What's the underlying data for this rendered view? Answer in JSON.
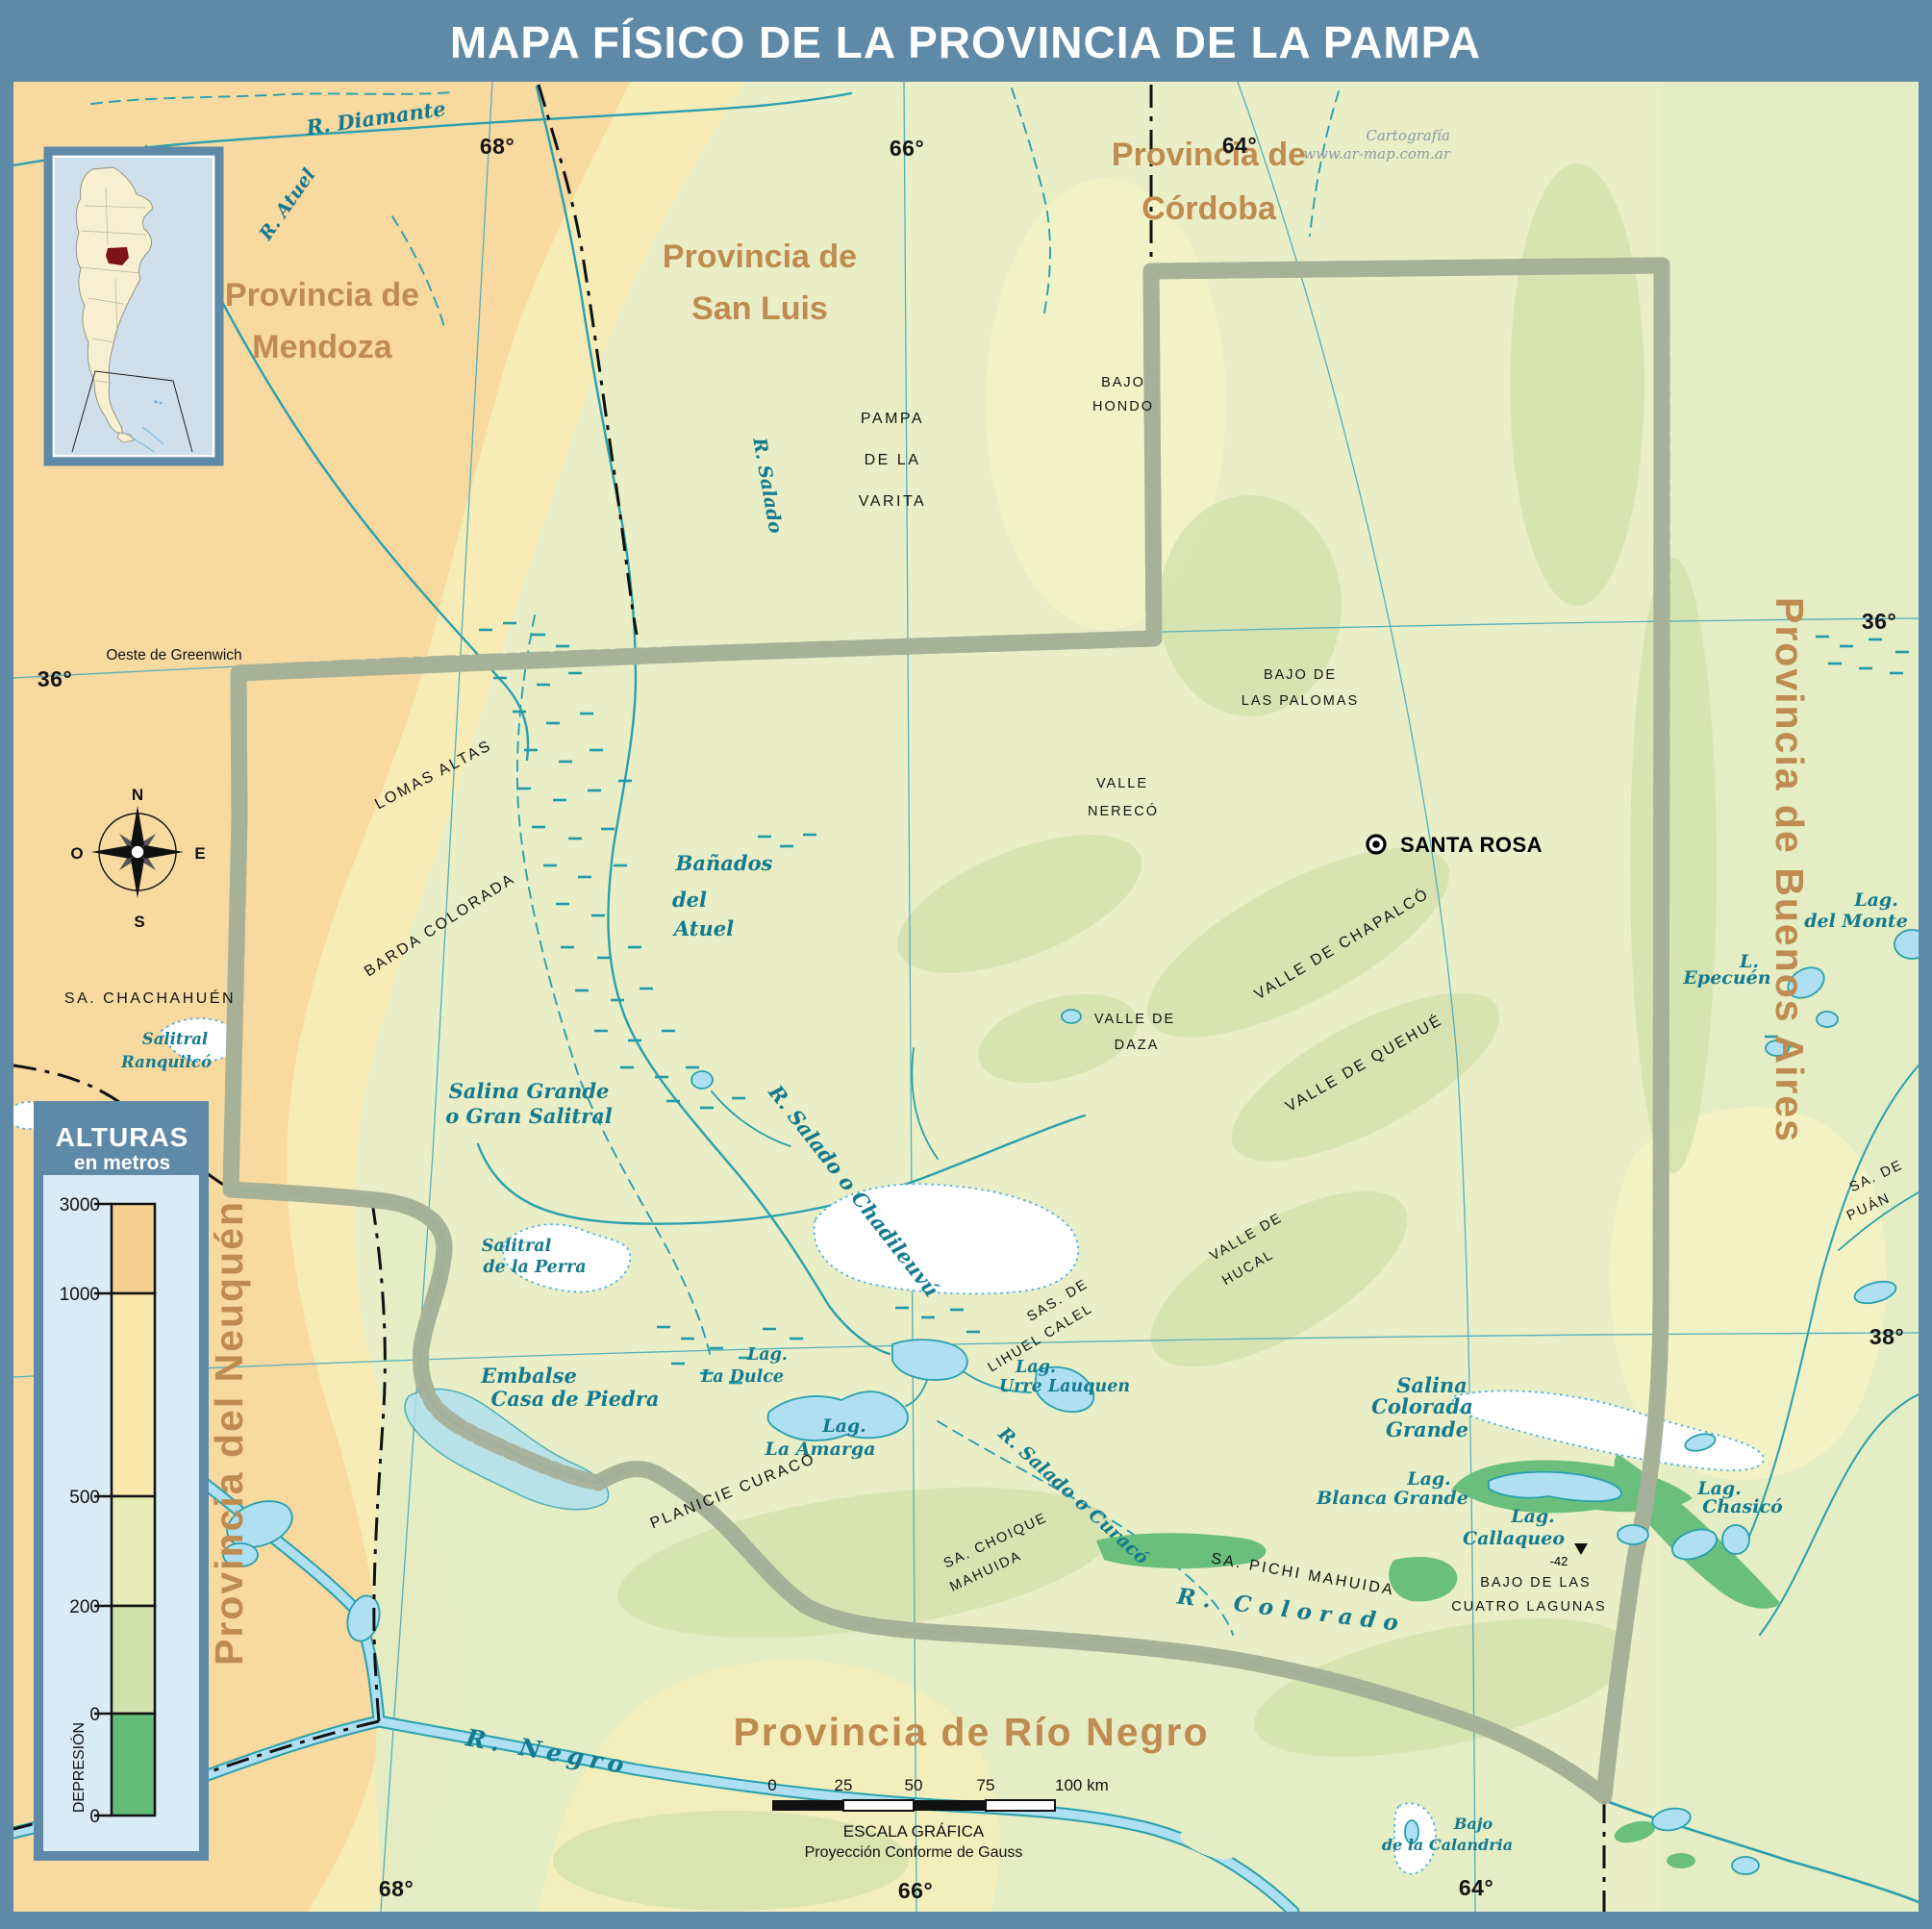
{
  "title": "MAPA FÍSICO DE LA PROVINCIA DE LA PAMPA",
  "credit": {
    "line1": "Cartografía",
    "line2": "www.ar-map.com.ar"
  },
  "colors": {
    "frame": "#5e89a7",
    "map_base": "#e9eec6",
    "west_orange": "#f8d9a0",
    "pale_yellow": "#f8ecb6",
    "valley_green": "#d3e2ad",
    "depression_green": "#69bf7b",
    "water_line": "#2aa0ae",
    "water_fill": "#aedff2",
    "water_label": "#157a8e",
    "province_label": "#bf8b51",
    "border_shadow": "#a6b199",
    "border_line": "#111111"
  },
  "graticule": {
    "greenwich": "Oeste de Greenwich",
    "top": [
      "68°",
      "66°",
      "64°"
    ],
    "bottom": [
      "68°",
      "66°",
      "64°"
    ],
    "left": [
      "36°"
    ],
    "right": [
      "36°",
      "38°"
    ]
  },
  "provinces": {
    "mendoza": [
      "Provincia de",
      "Mendoza"
    ],
    "sanluis": [
      "Provincia de",
      "San Luis"
    ],
    "cordoba": [
      "Provincia de",
      "Córdoba"
    ],
    "buenosaires": "Provincia de Buenos Aires",
    "neuquen": "Provincia del Neuquén",
    "rionegro": "Provincia de Río Negro"
  },
  "city": {
    "name": "SANTA ROSA"
  },
  "terrain": {
    "pampa1": "PAMPA",
    "pampa2": "DE LA",
    "pampa3": "VARITA",
    "bajohondo1": "BAJO",
    "bajohondo2": "HONDO",
    "palomas1": "BAJO DE",
    "palomas2": "LAS PALOMAS",
    "nereco1": "VALLE",
    "nereco2": "NERECÓ",
    "daza1": "VALLE DE",
    "daza2": "DAZA",
    "chapalco": "VALLE DE CHAPALCÓ",
    "quehue": "VALLE DE QUEHUÉ",
    "hucal1": "VALLE DE",
    "hucal2": "HUCAL",
    "lihuel1": "SAS. DE",
    "lihuel2": "LIHUEL CALEL",
    "choique1": "SA. CHOIQUE",
    "choique2": "MAHUIDA",
    "pichi": "SA. PICHI MAHUIDA",
    "cuatro1": "BAJO DE LAS",
    "cuatro2": "CUATRO LAGUNAS",
    "lomas": "LOMAS ALTAS",
    "barda": "BARDA COLORADA",
    "chachahuen": "SA. CHACHAHUÉN",
    "planicie": "PLANICIE CURACÓ",
    "puan1": "SA. DE",
    "puan2": "PUÁN",
    "depression_value": "-42"
  },
  "water": {
    "diamante": "R. Diamante",
    "atuel_r": "R. Atuel",
    "salado_r": "R. Salado",
    "banados1": "Bañados",
    "banados2": "del",
    "banados3": "Atuel",
    "salina1": "Salina Grande",
    "salina2": "o Gran Salitral",
    "ranquilco1": "Salitral",
    "ranquilco2": "Ranquilcó",
    "perra1": "Salitral",
    "perra2": "de la Perra",
    "embalse1": "Embalse",
    "embalse2": "Casa de Piedra",
    "chadileuvu": "R. Salado o Chadileuvú",
    "dulce1": "Lag.",
    "dulce2": "La Dulce",
    "urre1": "Lag.",
    "urre2": "Urre Lauquen",
    "amarga1": "Lag.",
    "amarga2": "La Amarga",
    "curaco": "R. Salado o Curacó",
    "colorado": "R. Colorado",
    "negro": "R. Negro",
    "scolorada1": "Salina",
    "scolorada2": "Colorada",
    "scolorada3": "Grande",
    "blanca1": "Lag.",
    "blanca2": "Blanca Grande",
    "callaqueo1": "Lag.",
    "callaqueo2": "Callaqueo",
    "chasico1": "Lag.",
    "chasico2": "Chasicó",
    "epecuen1": "L.",
    "epecuen2": "Epecuén",
    "monte1": "Lag.",
    "monte2": "del Monte",
    "calandria1": "Bajo",
    "calandria2": "de la Calandria"
  },
  "legend": {
    "title": "ALTURAS",
    "subtitle": "en metros",
    "ticks": [
      "3000",
      "1000",
      "500",
      "200",
      "0",
      "0"
    ],
    "depression_label": "DEPRESIÓN"
  },
  "compass": {
    "n": "N",
    "s": "S",
    "e": "E",
    "o": "O"
  },
  "scalebar": {
    "ticks": [
      "0",
      "25",
      "50",
      "75",
      "100 km"
    ],
    "title": "ESCALA GRÁFICA",
    "subtitle": "Proyección Conforme de Gauss"
  }
}
